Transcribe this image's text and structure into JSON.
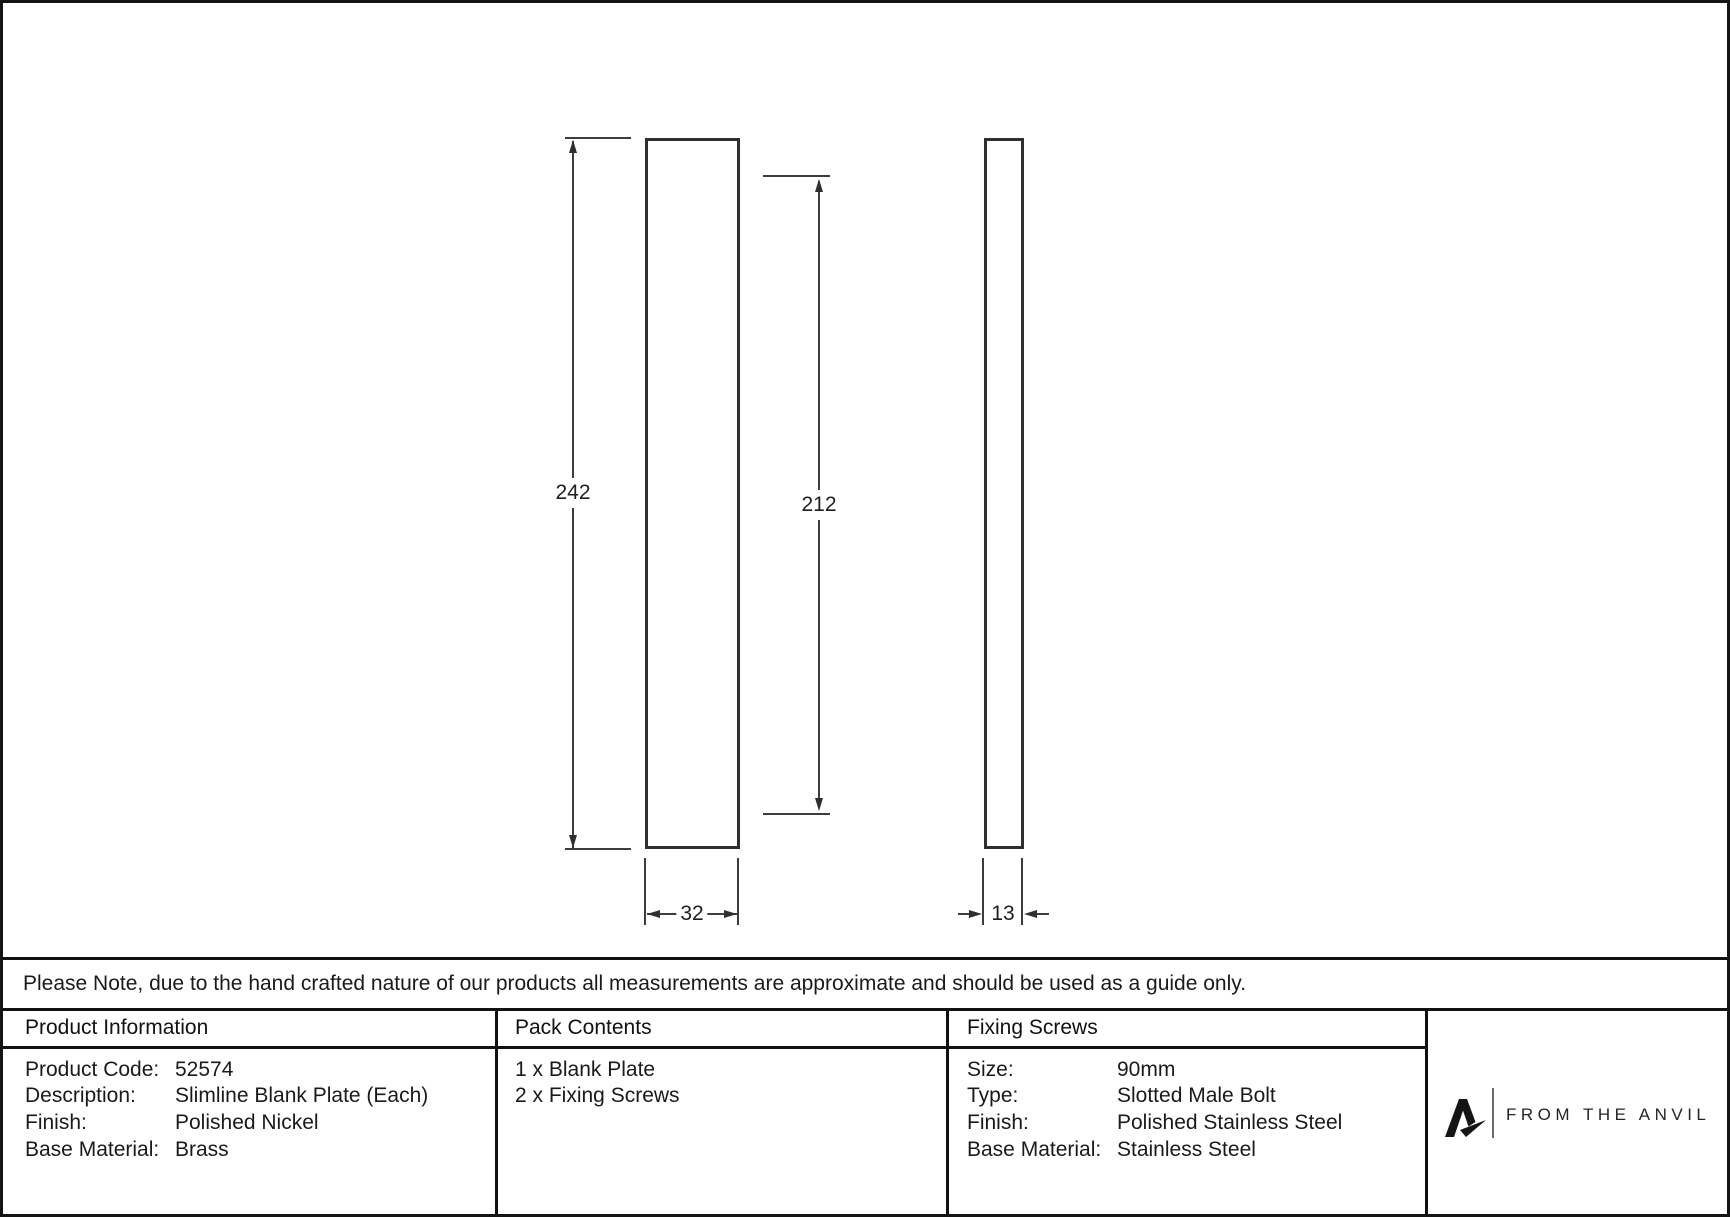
{
  "note": "Please Note, due to the hand crafted nature of our products all measurements are approximate and should be used as a guide only.",
  "drawing": {
    "front_height": "242",
    "fixing_centres": "212",
    "front_width": "32",
    "side_depth": "13"
  },
  "product_information": {
    "header": "Product Information",
    "rows": [
      {
        "label": "Product Code:",
        "value": "52574"
      },
      {
        "label": "Description:",
        "value": "Slimline Blank Plate (Each)"
      },
      {
        "label": "Finish:",
        "value": "Polished Nickel"
      },
      {
        "label": "Base Material:",
        "value": "Brass"
      }
    ]
  },
  "pack_contents": {
    "header": "Pack Contents",
    "items": [
      "1 x Blank Plate",
      "2 x Fixing Screws"
    ]
  },
  "fixing_screws": {
    "header": "Fixing Screws",
    "rows": [
      {
        "label": "Size:",
        "value": "90mm"
      },
      {
        "label": "Type:",
        "value": "Slotted Male Bolt"
      },
      {
        "label": "Finish:",
        "value": "Polished Stainless Steel"
      },
      {
        "label": "Base Material:",
        "value": "Stainless Steel"
      }
    ]
  },
  "brand": {
    "name": "FROM THE ANVIL"
  }
}
